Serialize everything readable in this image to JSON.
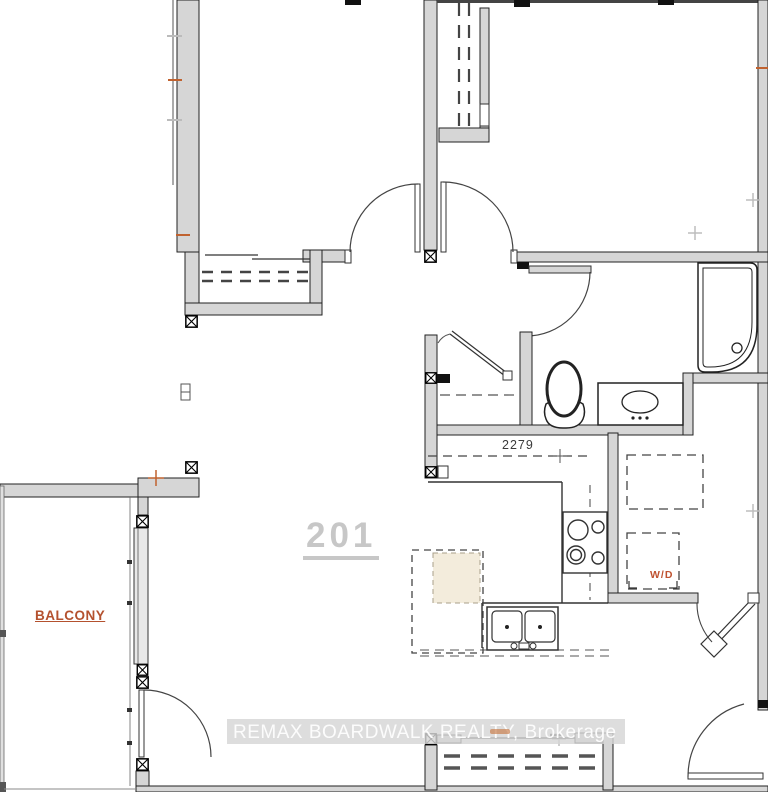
{
  "plan": {
    "unit_label": "201",
    "balcony_label": "BALCONY",
    "dimension_label": "2279",
    "washer_dryer_label": "W/D",
    "watermark_text": "REMAX BOARDWALK REALTY, Brokerage",
    "colors": {
      "wall_fill": "#d6d6d6",
      "line_dark": "#1c1c1c",
      "accent_orange": "#bf5230",
      "faded_label_gray": "#c7c7c7",
      "watermark_band": "#d5d5d5",
      "island_tan": "#f3ecdc"
    }
  }
}
